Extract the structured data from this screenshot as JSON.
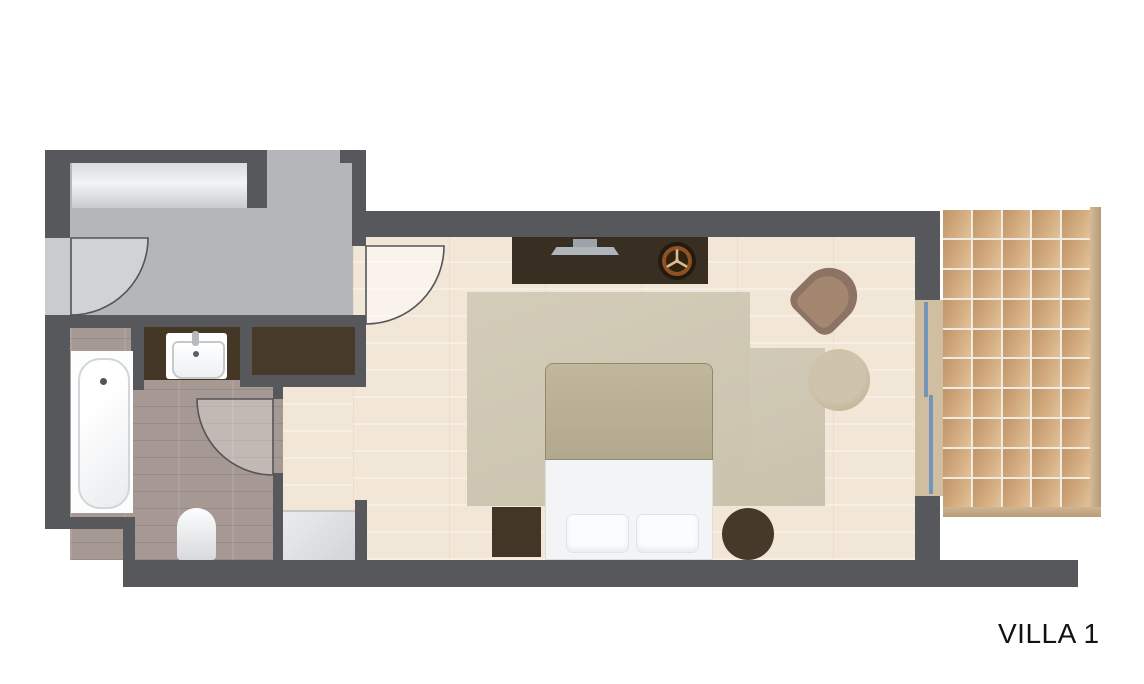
{
  "plan": {
    "title": "VILLA 1",
    "type": "floor-plan",
    "rooms": [
      "entrance",
      "bathroom",
      "bedroom",
      "terrace"
    ],
    "furniture": [
      "entry-door",
      "closet",
      "bathtub",
      "vanity-sink",
      "toilet",
      "shower",
      "built-in-wardrobe",
      "bathroom-door",
      "bedroom-door",
      "tv-sideboard",
      "tv",
      "decorative-fan",
      "armchair",
      "round-side-table",
      "rug",
      "double-bed",
      "pillows",
      "square-nightstand",
      "round-nightstand",
      "sliding-glass-door",
      "terrace-deck-tiles"
    ],
    "terrace_grid": {
      "cols": 5,
      "rows": 10
    }
  },
  "colors": {
    "wall": "#57585b",
    "entrance_floor": "#b4b6b9",
    "bathroom_floor": "#a69892",
    "bedroom_floor": "#f2e6d6",
    "rug": "#cfc8b4",
    "dark_furniture": "#42362a",
    "terrace_tile": "#cda178",
    "glass": "#7395ba",
    "background": "#ffffff"
  }
}
